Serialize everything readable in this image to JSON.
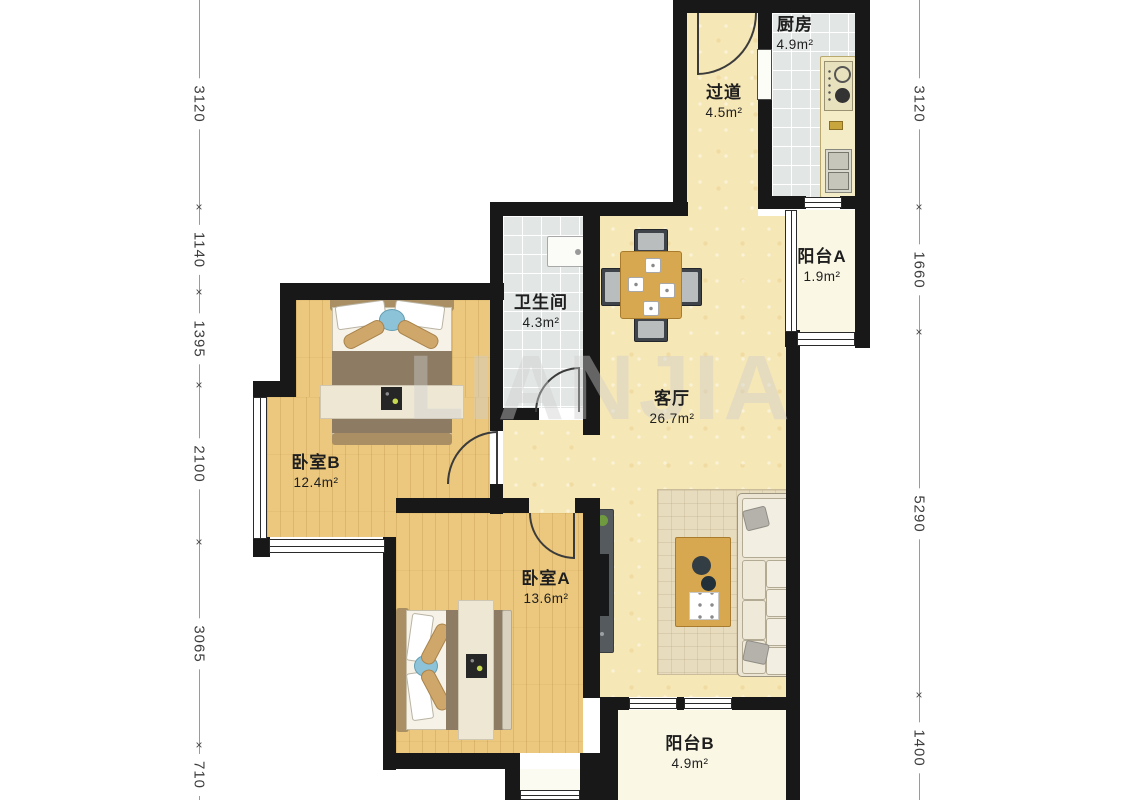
{
  "watermark": "LIANJIA",
  "rooms": {
    "kitchen": {
      "name": "厨房",
      "area": "4.9m²"
    },
    "hallway": {
      "name": "过道",
      "area": "4.5m²"
    },
    "balcony_a": {
      "name": "阳台A",
      "area": "1.9m²"
    },
    "bathroom": {
      "name": "卫生间",
      "area": "4.3m²"
    },
    "living": {
      "name": "客厅",
      "area": "26.7m²"
    },
    "bedroom_b": {
      "name": "卧室B",
      "area": "12.4m²"
    },
    "bedroom_a": {
      "name": "卧室A",
      "area": "13.6m²"
    },
    "balcony_b": {
      "name": "阳台B",
      "area": "4.9m²"
    }
  },
  "dimensions": {
    "left": [
      "3120",
      "1140",
      "1395",
      "2100",
      "3065",
      "710"
    ],
    "right": [
      "3120",
      "1660",
      "5290",
      "1400"
    ]
  },
  "palette": {
    "wall": "#181818",
    "wood_floor": "#ebc87e",
    "warm_floor": "#f6e7b6",
    "tile_floor": "#e2e6e5",
    "balcony_floor": "#faf7e4",
    "table_wood": "#d8a850",
    "duvet_brown": "#8d7b63",
    "accent_blue": "#8cc3d8",
    "watermark_gray": "#cfcfcf"
  }
}
